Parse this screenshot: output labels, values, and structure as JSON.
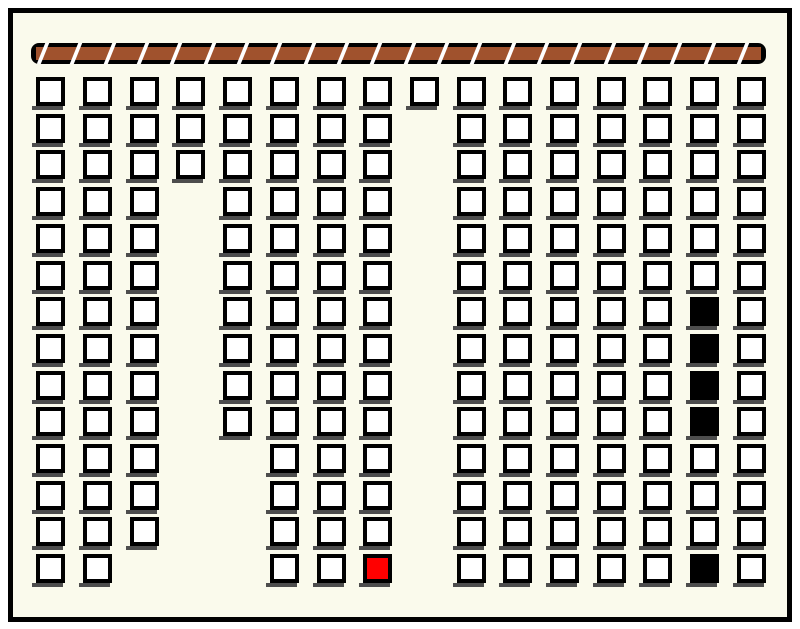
{
  "scene": {
    "colors": {
      "outer_background": "#FFFFFF",
      "inner_background": "#FAFAEC",
      "frame": "#000000",
      "square_fill": "#FFFFFF",
      "square_border": "#000000",
      "shadow": "#4D4D4D",
      "bar_fill": "#A0522D",
      "bar_gap": "#FFFFFF",
      "highlight_black": "#000000",
      "highlight_red": "#FF0000"
    }
  },
  "bar": {
    "x": 31,
    "y": 43,
    "width": 735,
    "height": 21,
    "gap_count": 22,
    "first_gap_offset": 5,
    "gap_pitch": 33.33,
    "skew_deg": -22
  },
  "grid": {
    "square_size": 29,
    "col_x": [
      36,
      83,
      130,
      176,
      223,
      270,
      317,
      363,
      410,
      457,
      503,
      550,
      597,
      643,
      690,
      737
    ],
    "row_y": [
      77,
      114,
      150,
      187,
      224,
      261,
      297,
      334,
      371,
      407,
      444,
      481,
      517,
      554
    ],
    "columns": [
      {
        "col": 1,
        "row_start": 1,
        "row_end": 14
      },
      {
        "col": 2,
        "row_start": 1,
        "row_end": 14
      },
      {
        "col": 3,
        "row_start": 1,
        "row_end": 13
      },
      {
        "col": 4,
        "row_start": 1,
        "row_end": 3
      },
      {
        "col": 5,
        "row_start": 1,
        "row_end": 10
      },
      {
        "col": 6,
        "row_start": 1,
        "row_end": 14
      },
      {
        "col": 7,
        "row_start": 1,
        "row_end": 14
      },
      {
        "col": 8,
        "row_start": 1,
        "row_end": 14
      },
      {
        "col": 9,
        "row_start": 1,
        "row_end": 1
      },
      {
        "col": 10,
        "row_start": 1,
        "row_end": 14
      },
      {
        "col": 11,
        "row_start": 1,
        "row_end": 14
      },
      {
        "col": 12,
        "row_start": 1,
        "row_end": 14
      },
      {
        "col": 13,
        "row_start": 1,
        "row_end": 14
      },
      {
        "col": 14,
        "row_start": 1,
        "row_end": 14
      },
      {
        "col": 15,
        "row_start": 1,
        "row_end": 14
      },
      {
        "col": 16,
        "row_start": 1,
        "row_end": 14
      }
    ],
    "filled_cells": [
      {
        "col": 15,
        "row": 7,
        "state": "black"
      },
      {
        "col": 15,
        "row": 8,
        "state": "black"
      },
      {
        "col": 15,
        "row": 9,
        "state": "black"
      },
      {
        "col": 15,
        "row": 10,
        "state": "black"
      },
      {
        "col": 15,
        "row": 14,
        "state": "black"
      },
      {
        "col": 8,
        "row": 14,
        "state": "red"
      }
    ],
    "counts": {
      "total_squares": 195,
      "black_squares": 5,
      "red_squares": 1,
      "columns": 16,
      "rows": 14
    }
  }
}
